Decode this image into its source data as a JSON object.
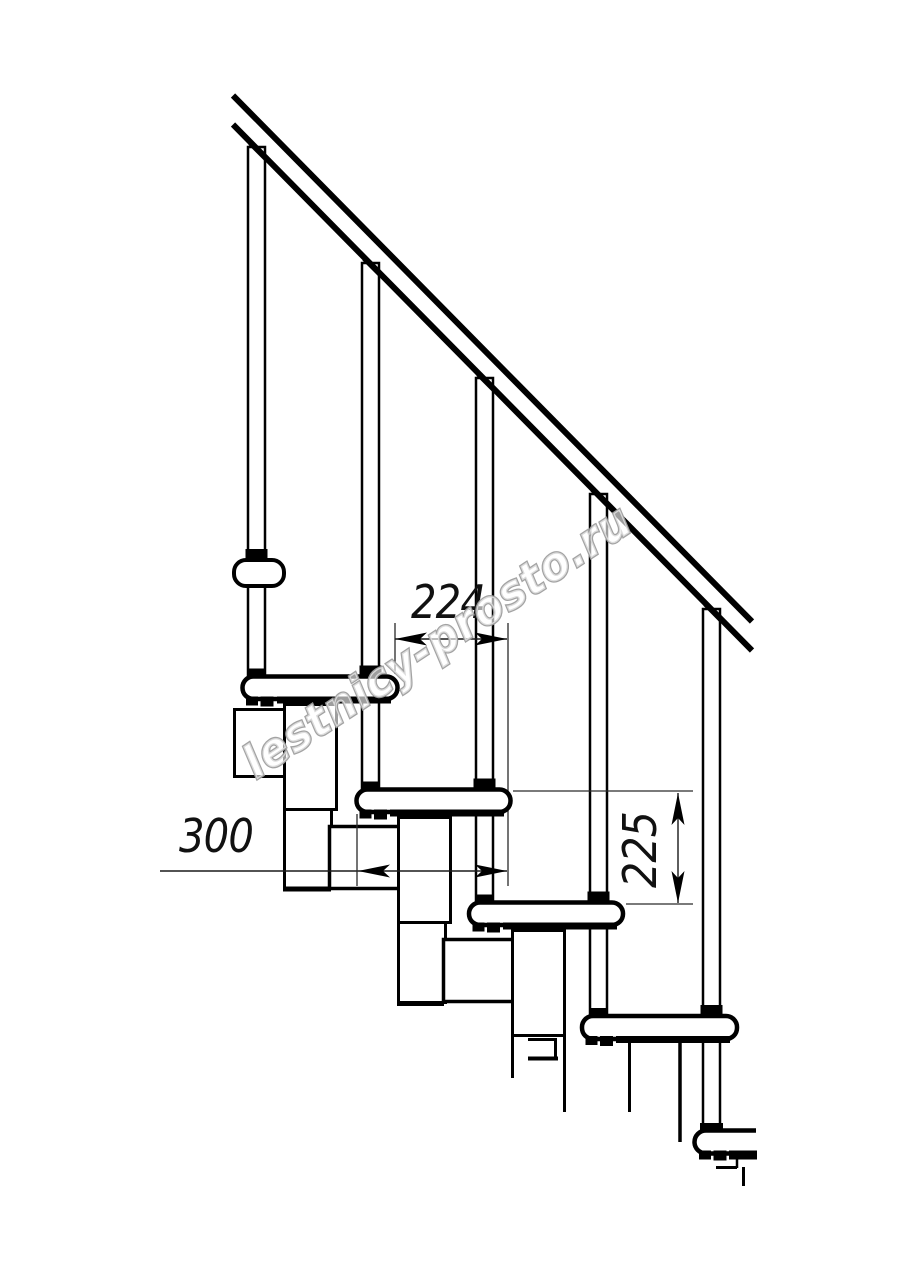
{
  "drawing": {
    "kind": "modular staircase side-view technical drawing",
    "background_color": "#ffffff",
    "line_color": "#000000",
    "tread_count": 5,
    "baluster_count": 5
  },
  "dimensions": {
    "step_run": {
      "label": "224"
    },
    "tread_depth": {
      "label": "300"
    },
    "riser_height": {
      "label": "225"
    }
  },
  "watermark": {
    "text": "lestnicy-prosto.ru",
    "color": "#9e9e9e"
  }
}
